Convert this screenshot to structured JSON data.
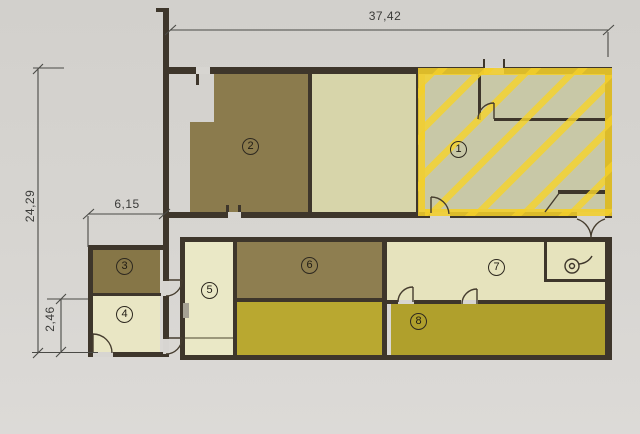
{
  "dimensions": {
    "top_width": "37,42",
    "left_height": "24,29",
    "annex_width": "6,15",
    "annex_height": "2,46"
  },
  "rooms": [
    {
      "number": "1",
      "highlighted": true
    },
    {
      "number": "2",
      "highlighted": false
    },
    {
      "number": "3",
      "highlighted": false
    },
    {
      "number": "4",
      "highlighted": false
    },
    {
      "number": "5",
      "highlighted": false
    },
    {
      "number": "6",
      "highlighted": false
    },
    {
      "number": "7",
      "highlighted": false
    },
    {
      "number": "8",
      "highlighted": false
    }
  ],
  "colors": {
    "paper": "#d7d5d1",
    "wall": "#3e362b",
    "olive_room": "#8b7b4d",
    "cream_room": "#e8e5c3",
    "cream_dark_room": "#d7d5aa",
    "yellow_green_room": "#b5a531",
    "room1_base": "#c8c8a7",
    "highlight_yellow": "#f3ce2a",
    "dimension_line": "#4a4a46"
  }
}
